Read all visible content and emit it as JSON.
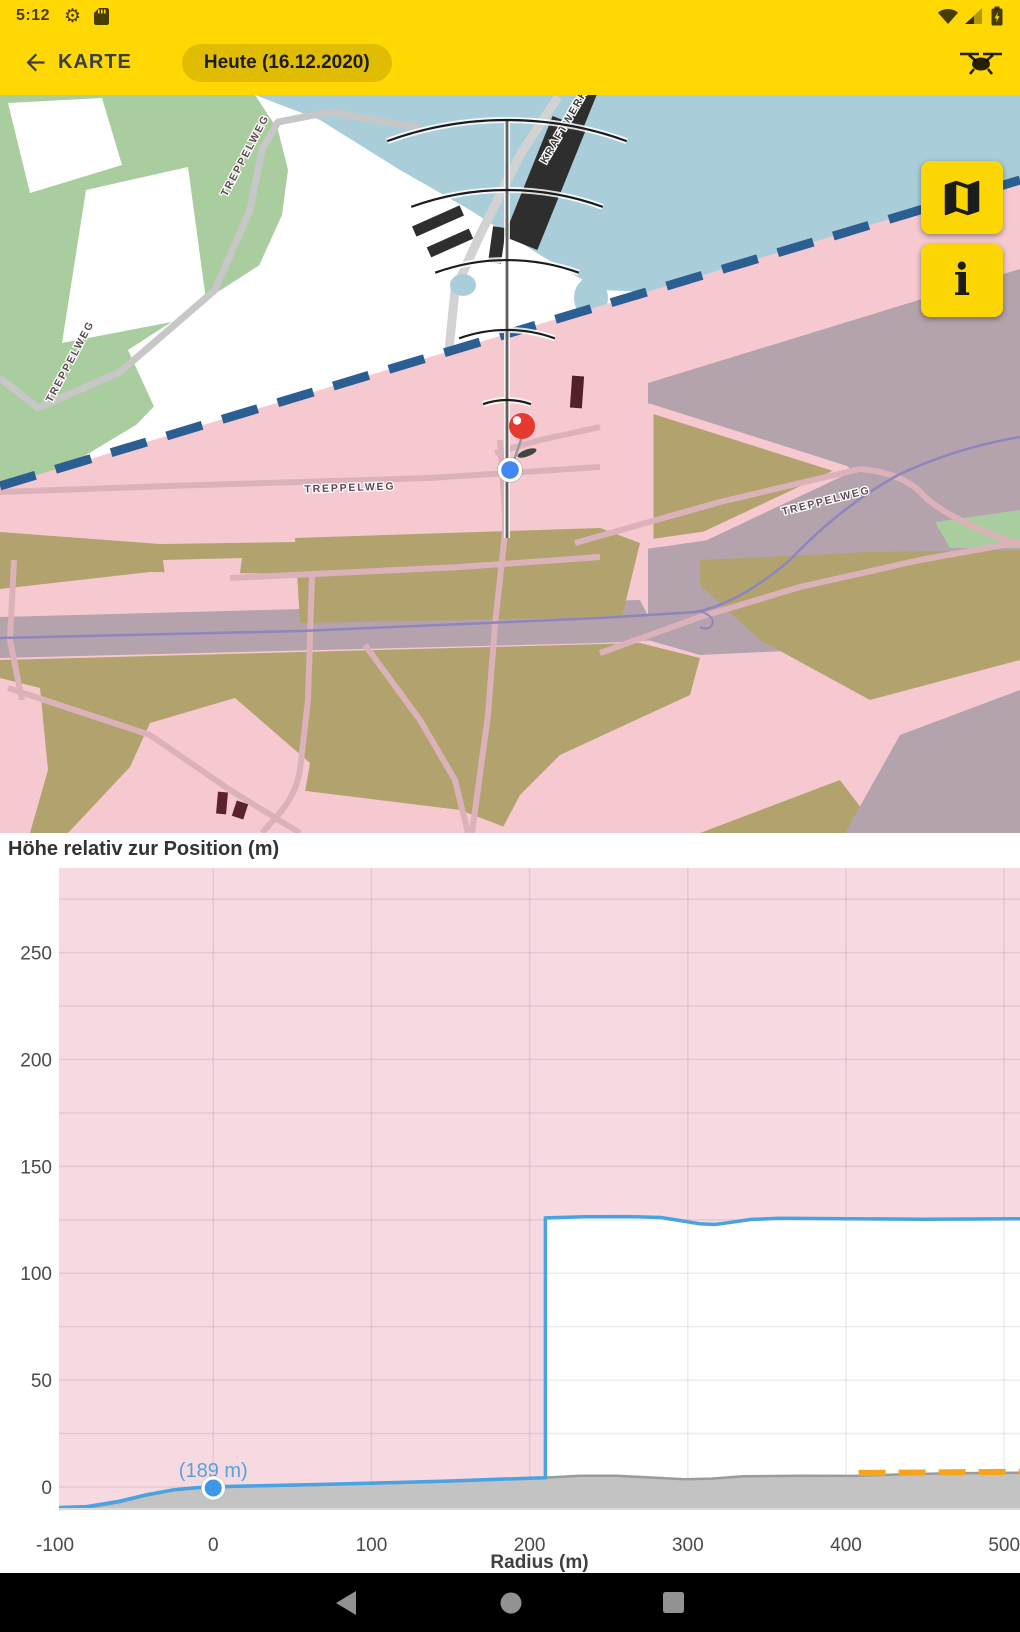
{
  "status_bar": {
    "time": "5:12"
  },
  "app_bar": {
    "title": "KARTE",
    "date_chip": "Heute (16.12.2020)"
  },
  "map": {
    "street_labels": {
      "treppelweg": "TREPPELWEG",
      "kraftwerk": "KRAFTWERK"
    },
    "info_button_glyph": "i"
  },
  "chart_data": {
    "type": "area",
    "title": "Höhe relativ zur Position (m)",
    "xlabel": "Radius (m)",
    "x_ticks": [
      -100,
      0,
      100,
      200,
      300,
      400,
      500
    ],
    "y_ticks": [
      0,
      50,
      100,
      150,
      200,
      250
    ],
    "x_range": [
      -97.5,
      510
    ],
    "y_range": [
      -10.3,
      289.6
    ],
    "grid_step_x": 100,
    "grid_step_y": 25,
    "marker": {
      "x": 0,
      "y": 0,
      "label": "(189 m)"
    },
    "series": [
      {
        "name": "max-height-limit",
        "color": "#49a2e2",
        "points": [
          [
            -97.5,
            -9.6
          ],
          [
            -80,
            -9.2
          ],
          [
            -60,
            -6.8
          ],
          [
            -42,
            -3.6
          ],
          [
            -25,
            -1.3
          ],
          [
            -10,
            -0.3
          ],
          [
            0,
            0.1
          ],
          [
            30,
            0.6
          ],
          [
            70,
            1.2
          ],
          [
            110,
            2.0
          ],
          [
            150,
            2.8
          ],
          [
            180,
            3.6
          ],
          [
            200,
            4.1
          ],
          [
            210,
            4.3
          ],
          [
            210,
            125.9
          ],
          [
            235,
            126.4
          ],
          [
            262,
            126.5
          ],
          [
            283,
            126.1
          ],
          [
            295,
            124.7
          ],
          [
            307,
            123.2
          ],
          [
            317,
            122.8
          ],
          [
            328,
            123.9
          ],
          [
            340,
            125.2
          ],
          [
            358,
            125.7
          ],
          [
            400,
            125.5
          ],
          [
            450,
            125.3
          ],
          [
            510,
            125.5
          ]
        ]
      },
      {
        "name": "terrain",
        "color": "#c3c3c3",
        "points": [
          [
            -97.5,
            -10.3
          ],
          [
            -80,
            -9.8
          ],
          [
            -60,
            -7.2
          ],
          [
            -42,
            -4.0
          ],
          [
            -25,
            -1.6
          ],
          [
            -10,
            -0.5
          ],
          [
            0,
            -0.1
          ],
          [
            30,
            0.4
          ],
          [
            70,
            1.0
          ],
          [
            110,
            1.8
          ],
          [
            150,
            2.6
          ],
          [
            185,
            3.6
          ],
          [
            210,
            4.4
          ],
          [
            232,
            5.3
          ],
          [
            255,
            5.3
          ],
          [
            275,
            4.5
          ],
          [
            298,
            3.6
          ],
          [
            315,
            3.9
          ],
          [
            335,
            5.0
          ],
          [
            370,
            5.3
          ],
          [
            405,
            5.2
          ],
          [
            430,
            5.8
          ],
          [
            465,
            6.4
          ],
          [
            510,
            6.7
          ]
        ]
      },
      {
        "name": "obstacle-warning",
        "color": "#f7a41d",
        "style": "dashed",
        "points": [
          [
            408,
            6.6
          ],
          [
            510,
            7.1
          ]
        ]
      }
    ]
  },
  "colors": {
    "app_bar_yellow": "#ffd703",
    "zone_dash_blue": "#2b5e91",
    "plot_pink": "#f7d9e2",
    "limit_blue": "#49a2e2",
    "terrain_gray": "#c3c3c3",
    "warning_orange": "#f7a41d",
    "marker_red": "#e6392f",
    "position_blue": "#4285f4",
    "map_water": "#a9ced9",
    "map_green": "#a9cd9f",
    "map_olive": "#b2a36e",
    "map_mauve": "#b4a2ac"
  }
}
